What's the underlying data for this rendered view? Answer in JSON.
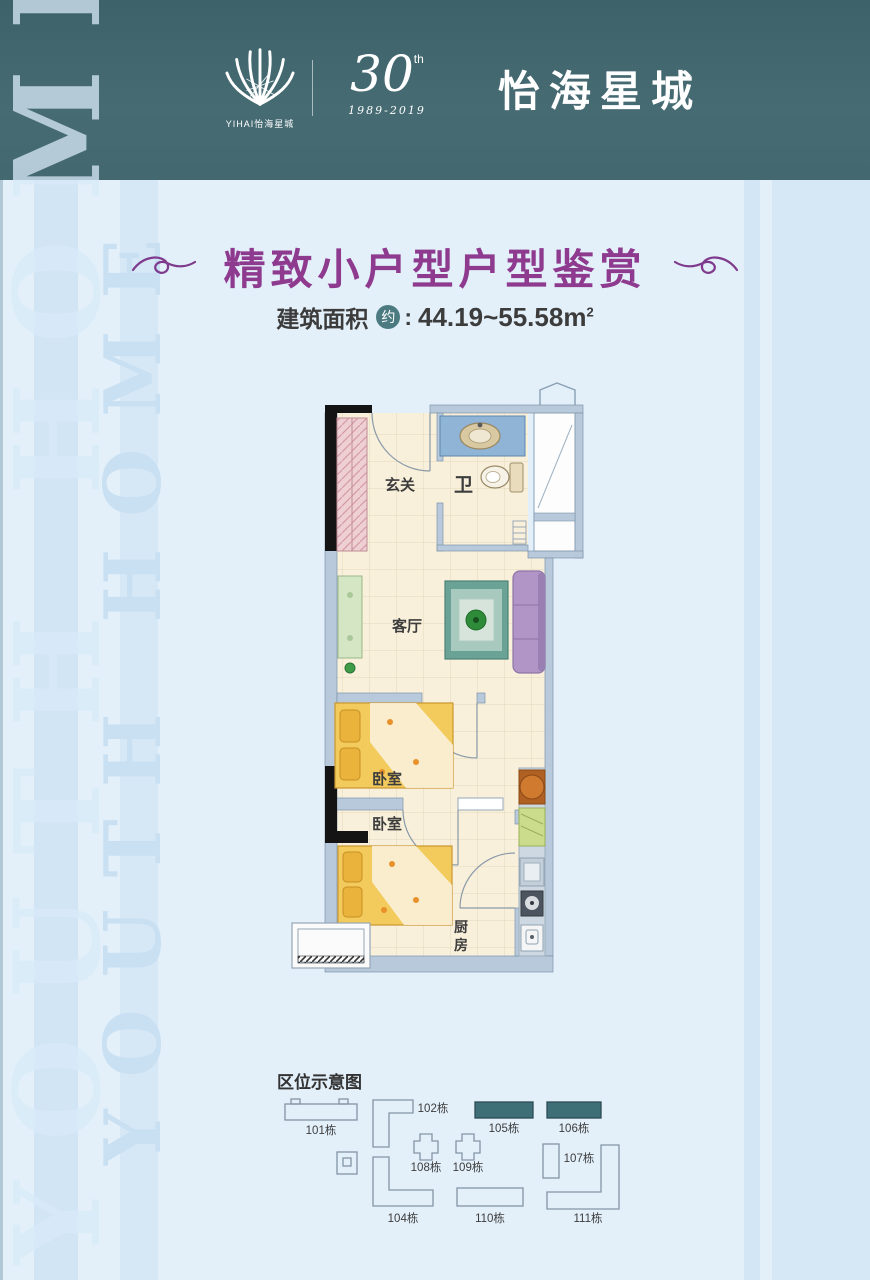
{
  "colors": {
    "header_bg": "#446970",
    "body_bg": "#e3f0fa",
    "title_purple": "#8e3a8f",
    "badge_teal": "#4b7b81",
    "site_highlight": "#3e6f77",
    "wall_blue": "#b7c9da",
    "floor_cream": "#f8f0db"
  },
  "header": {
    "logo_caption": "YIHAI怡海星城",
    "anniversary": {
      "number": "30",
      "suffix": "th",
      "years": "1989-2019"
    },
    "brand": "怡海星城"
  },
  "watermark": {
    "left": "YOUTH HOME",
    "right": "YOUTH HOME"
  },
  "title": {
    "text": "精致小户型户型鉴赏"
  },
  "area": {
    "label": "建筑面积",
    "badge": "约",
    "colon": ":",
    "value": "44.19~55.58",
    "unit": "m",
    "unit_sup": "2"
  },
  "floor_plan": {
    "rooms": {
      "foyer": "玄关",
      "bath": "卫",
      "living": "客厅",
      "bedroom_upper": "卧室",
      "bedroom_lower": "卧室",
      "kitchen": "厨房",
      "kitchen_chars": [
        "厨",
        "房"
      ]
    }
  },
  "site_plan": {
    "title": "区位示意图",
    "highlighted": [
      "105栋",
      "106栋"
    ],
    "buildings": [
      {
        "label": "101栋"
      },
      {
        "label": "102栋"
      },
      {
        "label": "104栋"
      },
      {
        "label": "105栋"
      },
      {
        "label": "106栋"
      },
      {
        "label": "107栋"
      },
      {
        "label": "108栋"
      },
      {
        "label": "109栋"
      },
      {
        "label": "110栋"
      },
      {
        "label": "111栋"
      }
    ]
  }
}
